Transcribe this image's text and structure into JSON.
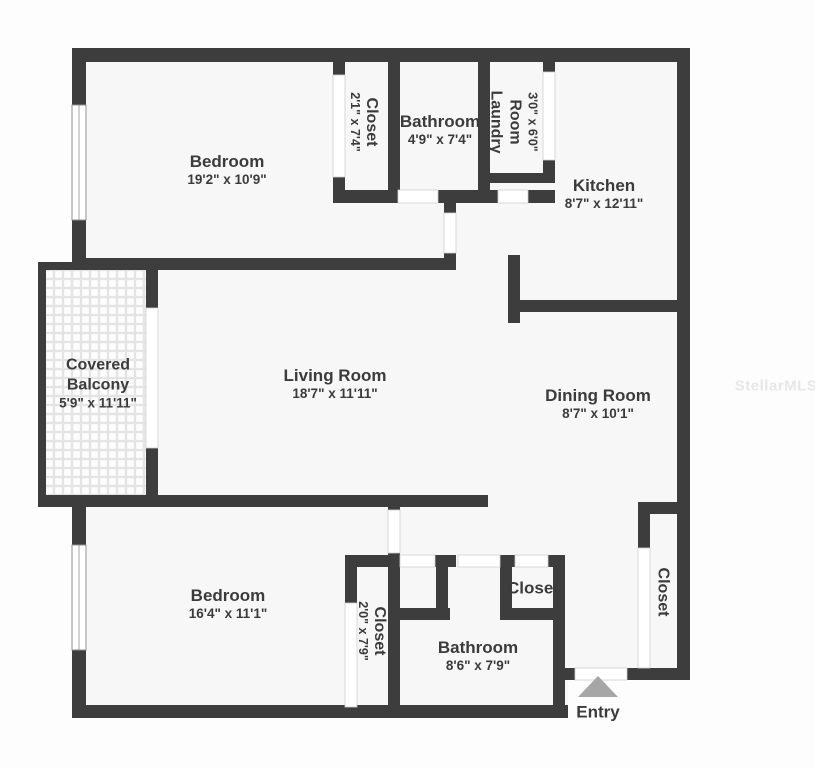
{
  "watermark": "StellarMLS",
  "entry": {
    "label": "Entry"
  },
  "colors": {
    "wall": "#3d3d3d",
    "floor": "#f7f7f7",
    "text": "#3b3b3b",
    "entry_arrow": "#a6a6a6",
    "watermark": "#e7e7e7"
  },
  "rooms": {
    "bedroom_top": {
      "name": "Bedroom",
      "dims": "19'2\" x 10'9\""
    },
    "closet_top": {
      "name": "Closet",
      "dims": "2'1\" x 7'4\""
    },
    "bathroom_top": {
      "name": "Bathroom",
      "dims": "4'9\" x 7'4\""
    },
    "laundry": {
      "name_line1": "Laundry",
      "name_line2": "Room",
      "dims": "3'0\" x 6'0\""
    },
    "kitchen": {
      "name": "Kitchen",
      "dims": "8'7\" x 12'11\""
    },
    "balcony": {
      "name_line1": "Covered",
      "name_line2": "Balcony",
      "dims": "5'9\" x 11'11\""
    },
    "living": {
      "name": "Living Room",
      "dims": "18'7\" x 11'11\""
    },
    "dining": {
      "name": "Dining Room",
      "dims": "8'7\" x 10'1\""
    },
    "bedroom_bottom": {
      "name": "Bedroom",
      "dims": "16'4\" x 11'1\""
    },
    "closet_bottom": {
      "name": "Closet",
      "dims": "2'0\" x 7'9\""
    },
    "bathroom_bottom": {
      "name": "Bathroom",
      "dims": "8'6\" x 7'9\""
    },
    "closet_hall": {
      "name": "Closet"
    },
    "closet_right": {
      "name": "Closet"
    }
  }
}
